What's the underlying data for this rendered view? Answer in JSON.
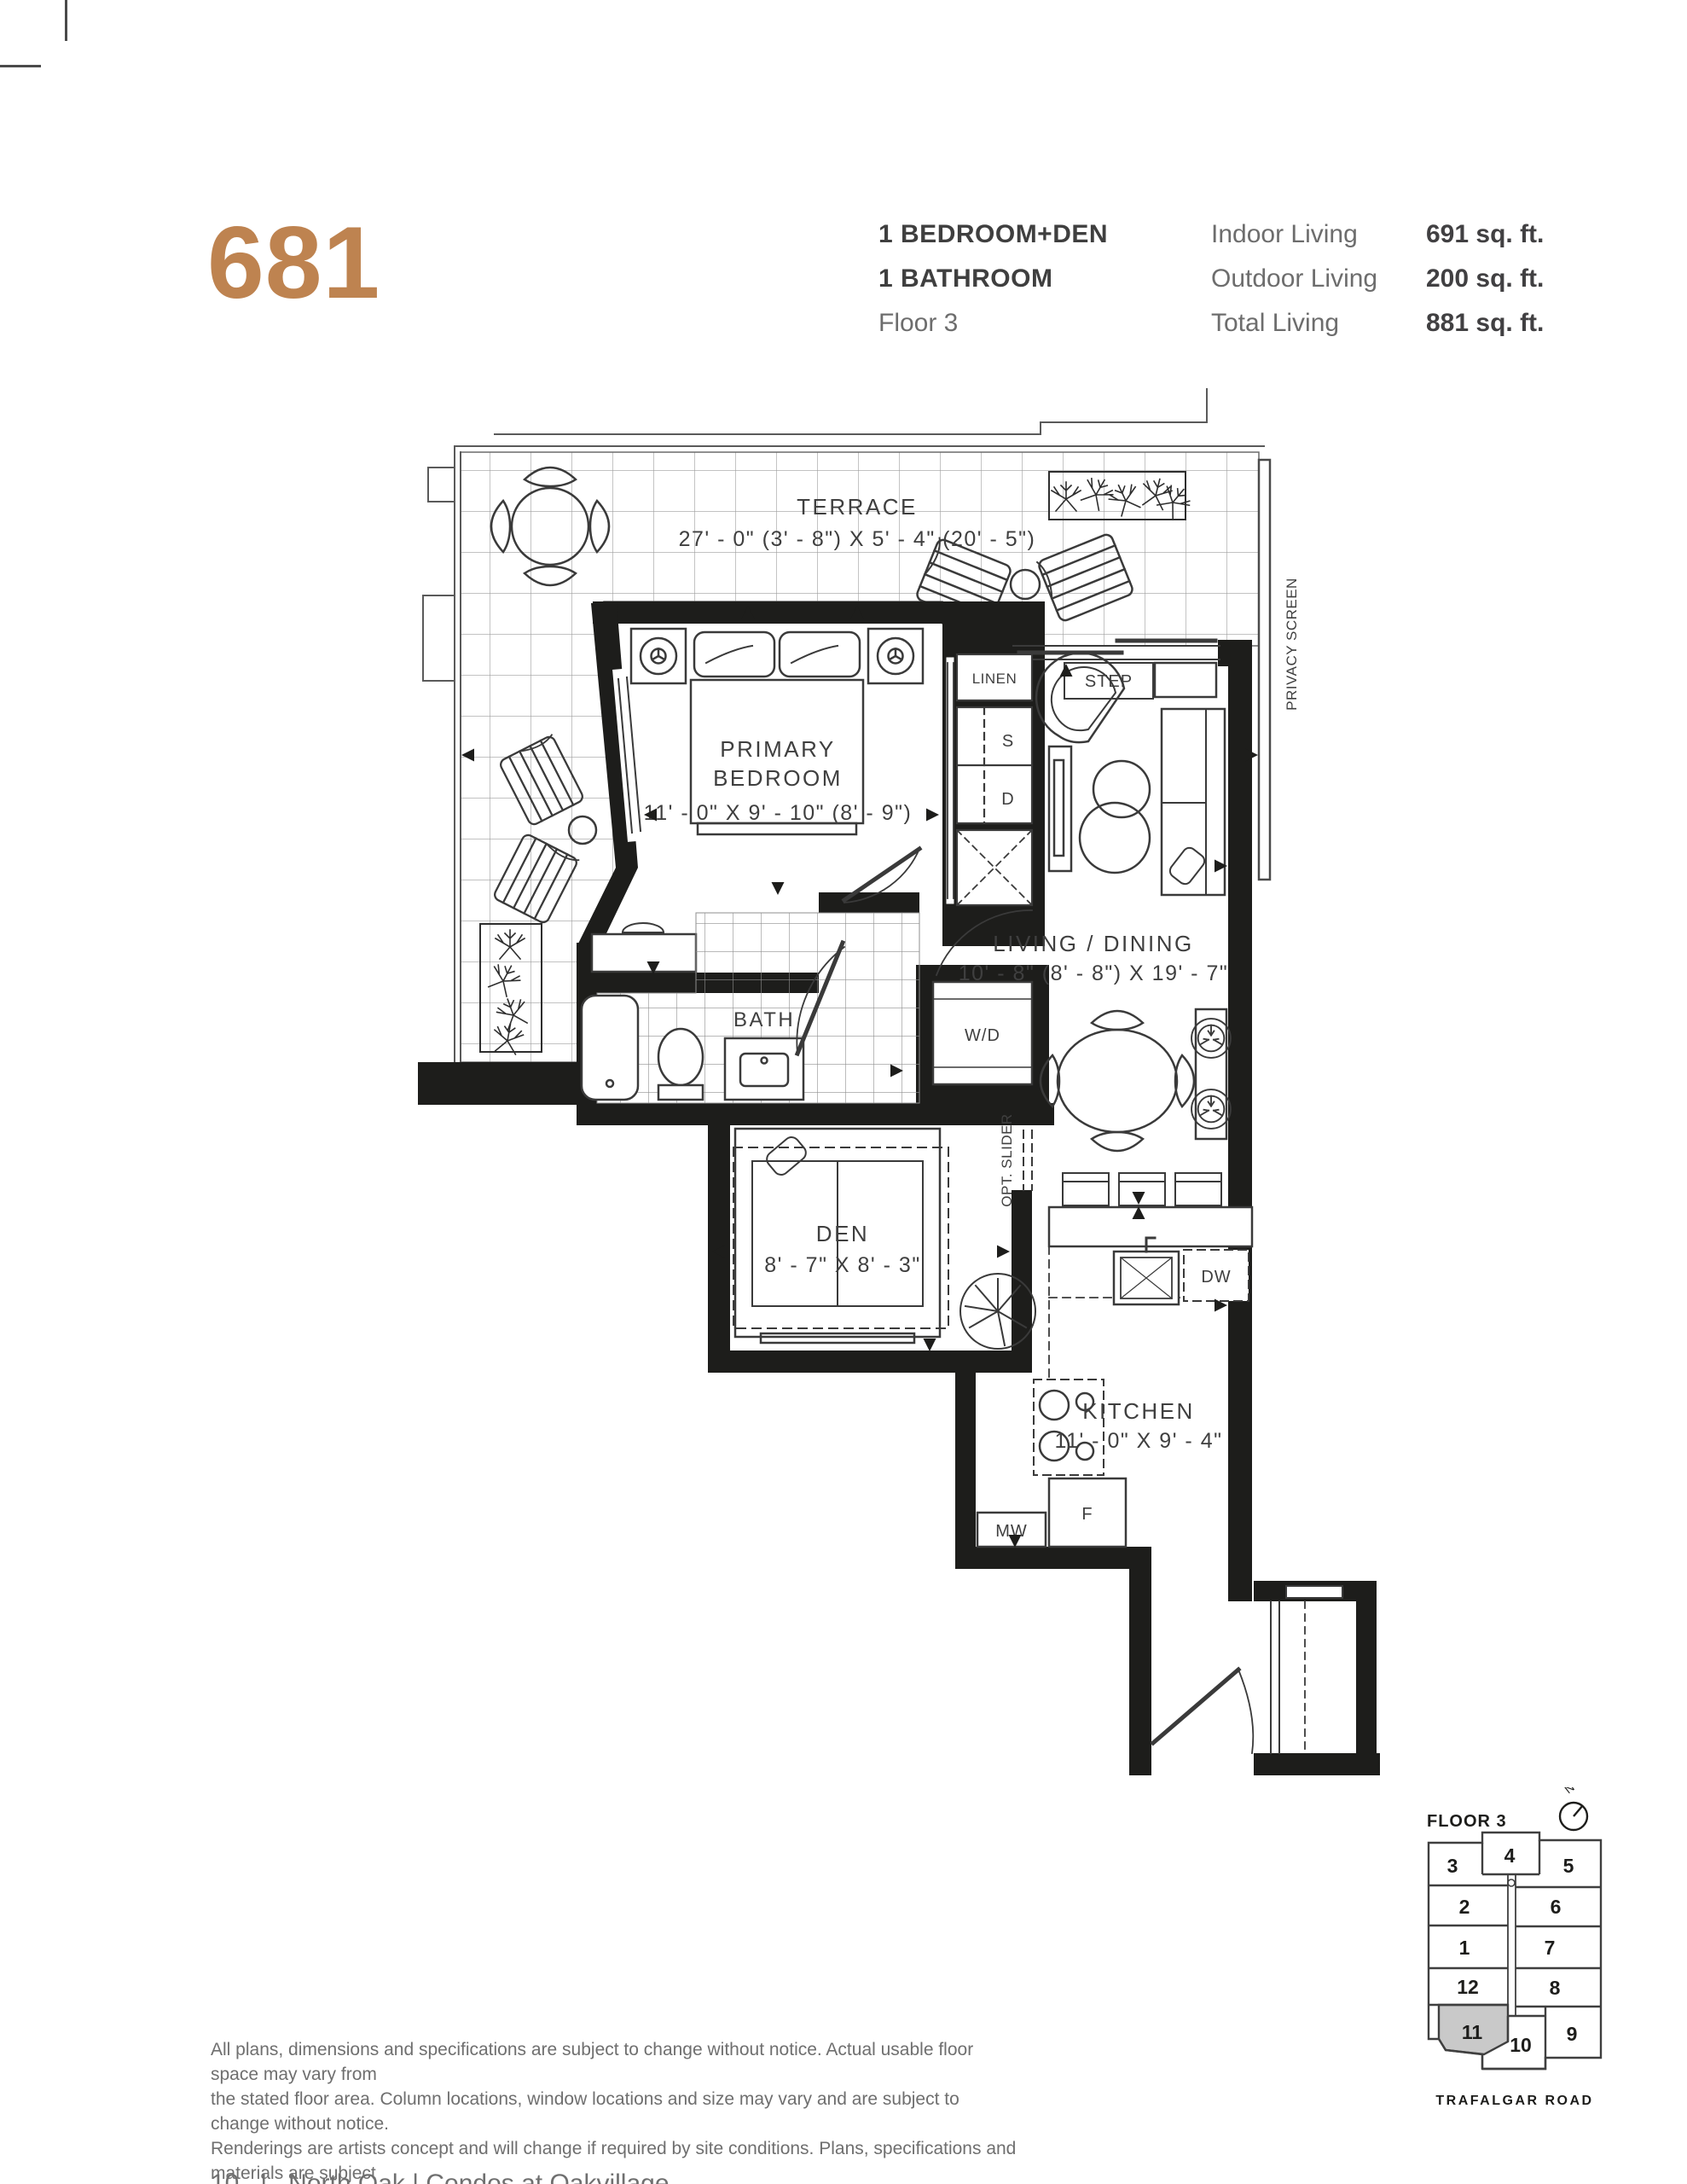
{
  "header": {
    "unit_number": "681",
    "unit_type_line1": "1 BEDROOM+DEN",
    "unit_type_line2": "1 BATHROOM",
    "floor": "Floor 3",
    "stats": [
      {
        "label": "Indoor Living",
        "value": "691 sq. ft."
      },
      {
        "label": "Outdoor Living",
        "value": "200 sq. ft."
      },
      {
        "label": "Total Living",
        "value": "881 sq. ft."
      }
    ]
  },
  "plan": {
    "terrace": {
      "name": "TERRACE",
      "dims": "27' - 0\" (3' - 8\") X 5' - 4\" (20' - 5\")"
    },
    "primary_bedroom": {
      "line1": "PRIMARY",
      "line2": "BEDROOM",
      "dims": "11' - 0\" X 9' - 10\" (8' - 9\")"
    },
    "bath": {
      "name": "BATH"
    },
    "living_dining": {
      "name": "LIVING / DINING",
      "dims": "10' - 8\" (8' - 8\") X 19' - 7\""
    },
    "den": {
      "name": "DEN",
      "dims": "8' - 7\" X 8' - 3\""
    },
    "kitchen": {
      "name": "KITCHEN",
      "dims": "11' - 0\" X 9' - 4\""
    },
    "labels": {
      "linen": "LINEN",
      "closet_s": "S",
      "closet_d": "D",
      "washer_dryer": "W/D",
      "step": "STEP",
      "opt_slider": "OPT. SLIDER",
      "privacy_screen": "PRIVACY SCREEN",
      "dishwasher": "DW",
      "microwave": "MW",
      "fridge": "F"
    }
  },
  "keyplan": {
    "floor_label": "FLOOR 3",
    "north_label": "N",
    "road_label": "TRAFALGAR ROAD",
    "highlighted_unit": "11",
    "units": [
      {
        "label": "3"
      },
      {
        "label": "4"
      },
      {
        "label": "5"
      },
      {
        "label": "2"
      },
      {
        "label": "6"
      },
      {
        "label": "1"
      },
      {
        "label": "7"
      },
      {
        "label": "12"
      },
      {
        "label": "8"
      },
      {
        "label": "11"
      },
      {
        "label": "10"
      },
      {
        "label": "9"
      }
    ]
  },
  "disclaimer": {
    "line1": "All plans, dimensions and specifications are subject to change without notice. Actual usable floor space may vary from",
    "line2": "the stated floor area. Column locations, window locations and size may vary and are subject to change without notice.",
    "line3": "Renderings are artists concept and will change if required by site conditions. Plans, specifications and materials are subject",
    "line4": "to availability, substitution, modification without notice at sole discretion of Minto Communities Inc.   E. & O.E. 1021"
  },
  "footer": {
    "text": "10   |   North Oak | Condos at Oakvillage"
  },
  "colors": {
    "accent": "#be8350",
    "wall": "#1d1d1b",
    "line": "#3a3a3a",
    "text_dark": "#3f3f3f",
    "text_gray": "#6d6d6d",
    "keyplan_highlight": "#c9c9c9"
  }
}
